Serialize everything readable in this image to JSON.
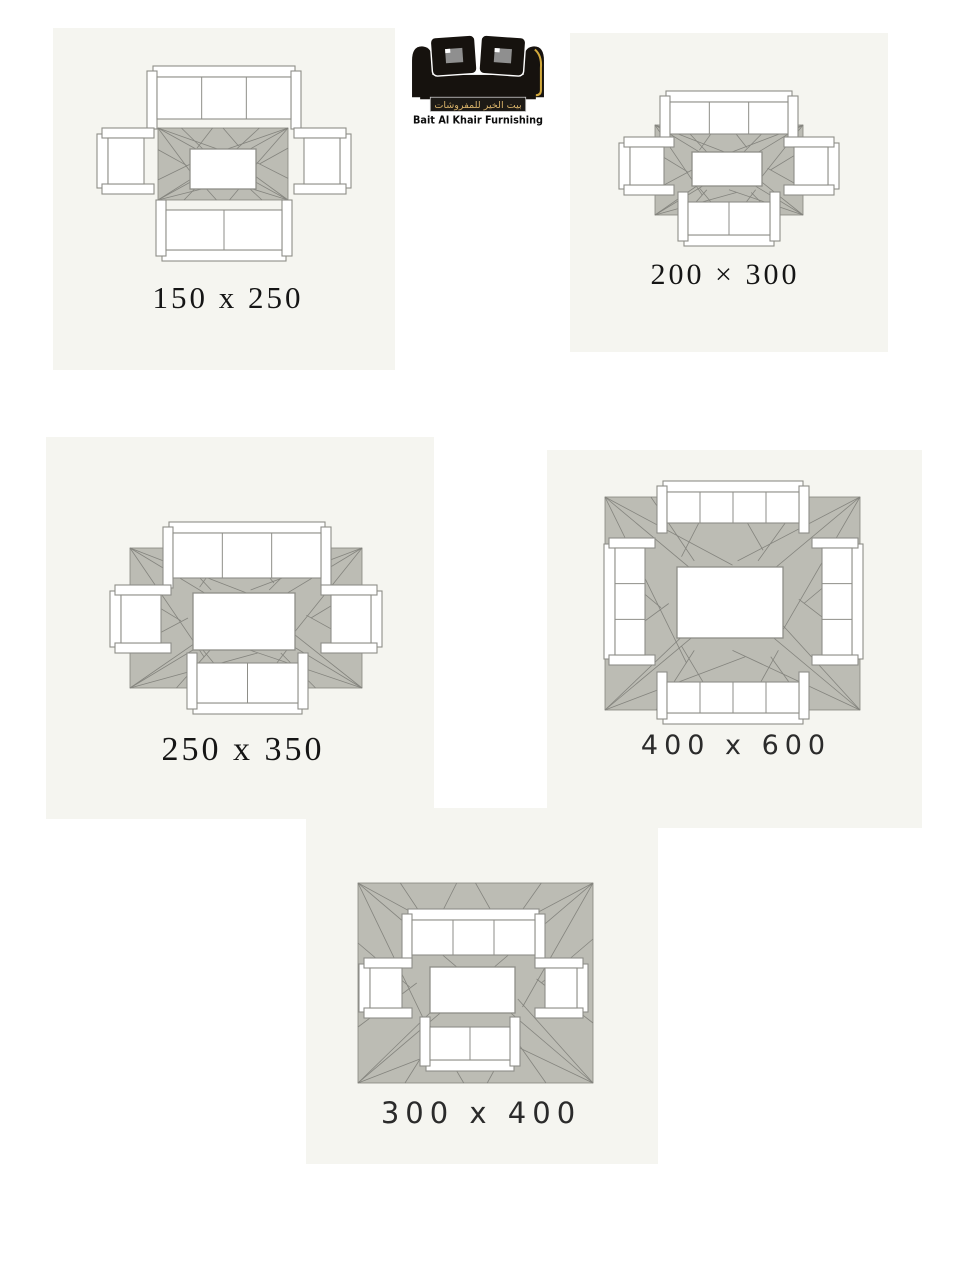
{
  "page": {
    "background": "#ffffff",
    "width": 960,
    "height": 1280
  },
  "brand": {
    "en": "Bait Al Khair Furnishing",
    "ar": "بيت الخير للمفروشات",
    "gold": "#d2a93c",
    "band_bg": "#1d1a16",
    "band_border": "#c9c9c9",
    "band_text_color": "#d9b36a",
    "sofa_black": "#16120e",
    "text_black": "#0d0d0d",
    "pillow_inner_gray": "#8f8f8f"
  },
  "palette": {
    "panel_bg": "#f5f5f0",
    "rug_fill": "#bcbcb4",
    "rug_line": "#84847e",
    "furn_fill": "#ffffff",
    "furn_line": "#8e8e88"
  },
  "rug_pattern": [
    [
      0,
      0,
      1,
      1
    ],
    [
      1,
      0,
      0,
      1
    ],
    [
      0,
      0,
      0.5,
      0.32
    ],
    [
      0,
      0,
      0.32,
      0.78
    ],
    [
      1,
      0,
      0.52,
      0.3
    ],
    [
      1,
      0,
      0.7,
      0.62
    ],
    [
      0,
      1,
      0.35,
      0.6
    ],
    [
      0,
      1,
      0.55,
      0.75
    ],
    [
      1,
      1,
      0.68,
      0.58
    ],
    [
      1,
      1,
      0.5,
      0.72
    ],
    [
      0.18,
      0,
      0.35,
      0.3
    ],
    [
      0.42,
      0,
      0.3,
      0.28
    ],
    [
      0.5,
      0,
      0.62,
      0.25
    ],
    [
      0.78,
      0,
      0.6,
      0.3
    ],
    [
      0.2,
      1,
      0.35,
      0.72
    ],
    [
      0.45,
      1,
      0.3,
      0.7
    ],
    [
      0.55,
      1,
      0.68,
      0.72
    ],
    [
      0.8,
      1,
      0.65,
      0.75
    ],
    [
      0,
      0.3,
      0.22,
      0.52
    ],
    [
      0,
      0.72,
      0.25,
      0.5
    ],
    [
      1,
      0.28,
      0.78,
      0.5
    ],
    [
      1,
      0.7,
      0.76,
      0.48
    ]
  ],
  "panels": [
    {
      "id": "150x250",
      "label": "150 x 250",
      "label_style": "serif",
      "label_size": 31,
      "frame": {
        "left": 53,
        "top": 28,
        "width": 342,
        "height": 342
      },
      "label_pos": {
        "cx": 175,
        "top": 254
      },
      "rug": {
        "x": 105,
        "y": 100,
        "w": 130,
        "h": 72
      },
      "furniture": [
        {
          "type": "sofa",
          "orient": "down",
          "x": 104,
          "y": 49,
          "w": 134,
          "h": 42,
          "cushions": 3
        },
        {
          "type": "sofa",
          "orient": "up",
          "x": 113,
          "y": 182,
          "w": 116,
          "h": 40,
          "cushions": 2
        },
        {
          "type": "armchair",
          "orient": "right",
          "x": 55,
          "y": 110,
          "w": 36,
          "h": 46,
          "cushions": 1
        },
        {
          "type": "armchair",
          "orient": "left",
          "x": 251,
          "y": 110,
          "w": 36,
          "h": 46,
          "cushions": 1
        },
        {
          "type": "table",
          "x": 137,
          "y": 121,
          "w": 66,
          "h": 40
        }
      ]
    },
    {
      "id": "200x300",
      "label": "200 × 300",
      "label_style": "serif",
      "label_size": 30,
      "frame": {
        "left": 570,
        "top": 33,
        "width": 318,
        "height": 319
      },
      "label_pos": {
        "cx": 155,
        "top": 227
      },
      "rug": {
        "x": 85,
        "y": 92,
        "w": 148,
        "h": 90
      },
      "furniture": [
        {
          "type": "sofa",
          "orient": "down",
          "x": 100,
          "y": 69,
          "w": 118,
          "h": 32,
          "cushions": 3
        },
        {
          "type": "sofa",
          "orient": "up",
          "x": 118,
          "y": 169,
          "w": 82,
          "h": 33,
          "cushions": 2
        },
        {
          "type": "armchair",
          "orient": "right",
          "x": 60,
          "y": 114,
          "w": 34,
          "h": 38,
          "cushions": 1
        },
        {
          "type": "armchair",
          "orient": "left",
          "x": 224,
          "y": 114,
          "w": 34,
          "h": 38,
          "cushions": 1
        },
        {
          "type": "table",
          "x": 122,
          "y": 119,
          "w": 70,
          "h": 34
        }
      ]
    },
    {
      "id": "250x350",
      "label": "250 x 350",
      "label_style": "serif",
      "label_size": 34,
      "frame": {
        "left": 46,
        "top": 437,
        "width": 388,
        "height": 382
      },
      "label_pos": {
        "cx": 197,
        "top": 296
      },
      "rug": {
        "x": 84,
        "y": 111,
        "w": 232,
        "h": 140
      },
      "furniture": [
        {
          "type": "sofa",
          "orient": "down",
          "x": 127,
          "y": 96,
          "w": 148,
          "h": 45,
          "cushions": 3
        },
        {
          "type": "sofa",
          "orient": "up",
          "x": 151,
          "y": 226,
          "w": 101,
          "h": 40,
          "cushions": 2
        },
        {
          "type": "armchair",
          "orient": "right",
          "x": 75,
          "y": 158,
          "w": 40,
          "h": 48,
          "cushions": 1
        },
        {
          "type": "armchair",
          "orient": "left",
          "x": 285,
          "y": 158,
          "w": 40,
          "h": 48,
          "cushions": 1
        },
        {
          "type": "table",
          "x": 147,
          "y": 156,
          "w": 102,
          "h": 57
        }
      ]
    },
    {
      "id": "400x600",
      "label": "400 x 600",
      "label_style": "sans",
      "label_size": 27,
      "frame": {
        "left": 547,
        "top": 450,
        "width": 375,
        "height": 378
      },
      "label_pos": {
        "cx": 189,
        "top": 282
      },
      "rug": {
        "x": 58,
        "y": 47,
        "w": 255,
        "h": 213
      },
      "furniture": [
        {
          "type": "sofa",
          "orient": "down",
          "x": 120,
          "y": 42,
          "w": 132,
          "h": 31,
          "cushions": 4
        },
        {
          "type": "sofa",
          "orient": "up",
          "x": 120,
          "y": 232,
          "w": 132,
          "h": 31,
          "cushions": 4
        },
        {
          "type": "sofa",
          "orient": "right",
          "x": 68,
          "y": 98,
          "w": 30,
          "h": 107,
          "cushions": 3
        },
        {
          "type": "sofa",
          "orient": "left",
          "x": 275,
          "y": 98,
          "w": 30,
          "h": 107,
          "cushions": 3
        },
        {
          "type": "table",
          "x": 130,
          "y": 117,
          "w": 106,
          "h": 71
        }
      ]
    },
    {
      "id": "300x400",
      "label": "300 x 400",
      "label_style": "sans",
      "label_size": 29,
      "frame": {
        "left": 306,
        "top": 808,
        "width": 352,
        "height": 356
      },
      "label_pos": {
        "cx": 175,
        "top": 291
      },
      "rug": {
        "x": 52,
        "y": 75,
        "w": 235,
        "h": 200
      },
      "furniture": [
        {
          "type": "sofa",
          "orient": "down",
          "x": 106,
          "y": 112,
          "w": 123,
          "h": 35,
          "cushions": 3
        },
        {
          "type": "sofa",
          "orient": "up",
          "x": 124,
          "y": 219,
          "w": 80,
          "h": 33,
          "cushions": 2
        },
        {
          "type": "armchair",
          "orient": "right",
          "x": 64,
          "y": 160,
          "w": 32,
          "h": 40,
          "cushions": 1
        },
        {
          "type": "armchair",
          "orient": "left",
          "x": 239,
          "y": 160,
          "w": 32,
          "h": 40,
          "cushions": 1
        },
        {
          "type": "table",
          "x": 124,
          "y": 159,
          "w": 85,
          "h": 46
        }
      ]
    }
  ]
}
